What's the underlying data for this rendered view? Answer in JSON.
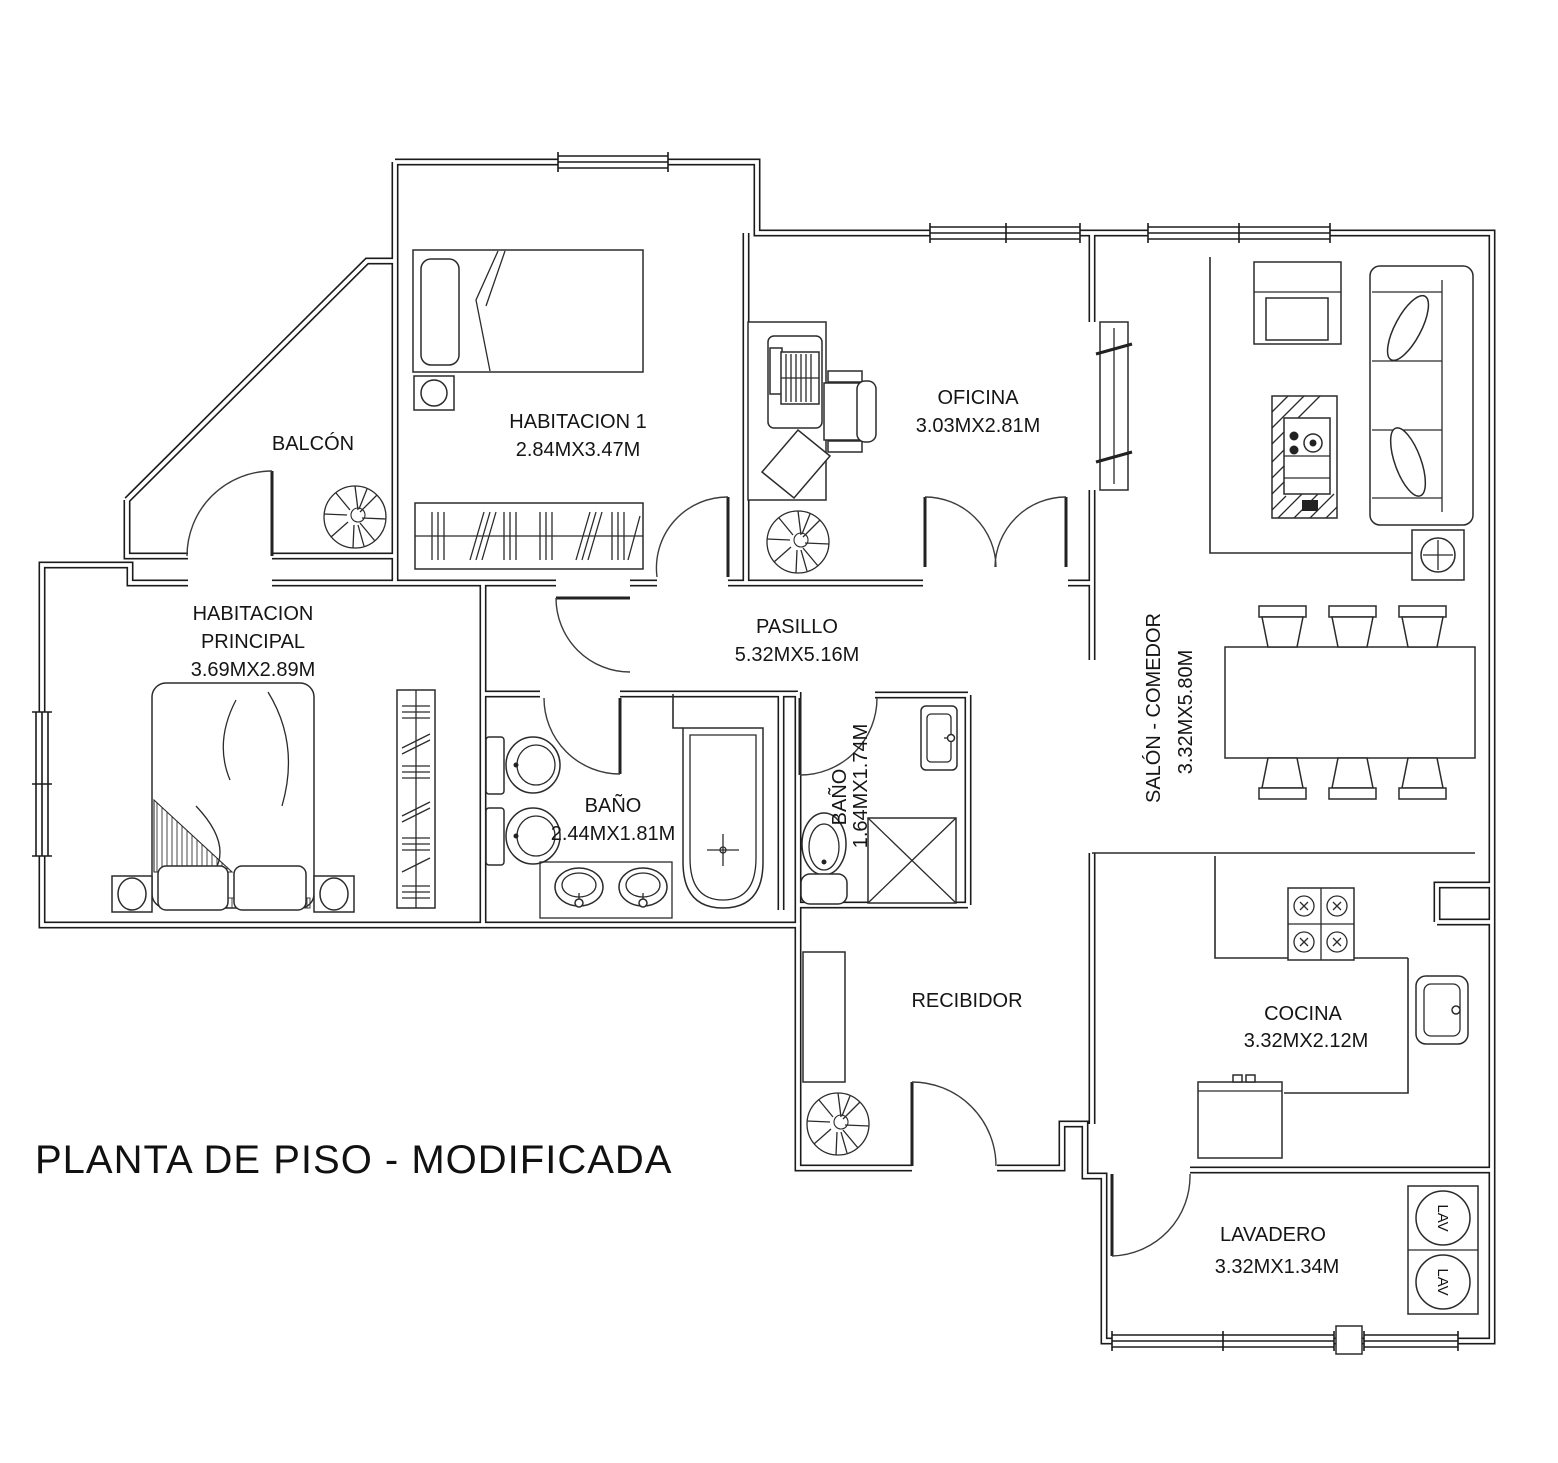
{
  "title": "PLANTA DE PISO - MODIFICADA",
  "rooms": {
    "balcon": {
      "name": "BALCÓN"
    },
    "habitacion1": {
      "name": "HABITACION 1",
      "dims": "2.84MX3.47M"
    },
    "oficina": {
      "name": "OFICINA",
      "dims": "3.03MX2.81M"
    },
    "habitacion_principal": {
      "name": "HABITACION",
      "name2": "PRINCIPAL",
      "dims": "3.69MX2.89M"
    },
    "pasillo": {
      "name": "PASILLO",
      "dims": "5.32MX5.16M"
    },
    "bano_grande": {
      "name": "BAÑO",
      "dims": "2.44MX1.81M"
    },
    "bano_pequeno": {
      "name": "BAÑO",
      "dims": "1.64MX1.74M"
    },
    "salon_comedor": {
      "name": "SALÓN - COMEDOR",
      "dims": "3.32MX5.80M"
    },
    "recibidor": {
      "name": "RECIBIDOR"
    },
    "cocina": {
      "name": "COCINA",
      "dims": "3.32MX2.12M"
    },
    "lavadero": {
      "name": "LAVADERO",
      "dims": "3.32MX1.34M"
    }
  },
  "appliances": {
    "washer1": "LAV",
    "washer2": "LAV"
  },
  "colors": {
    "line": "#1b1b1b",
    "background": "#ffffff"
  }
}
